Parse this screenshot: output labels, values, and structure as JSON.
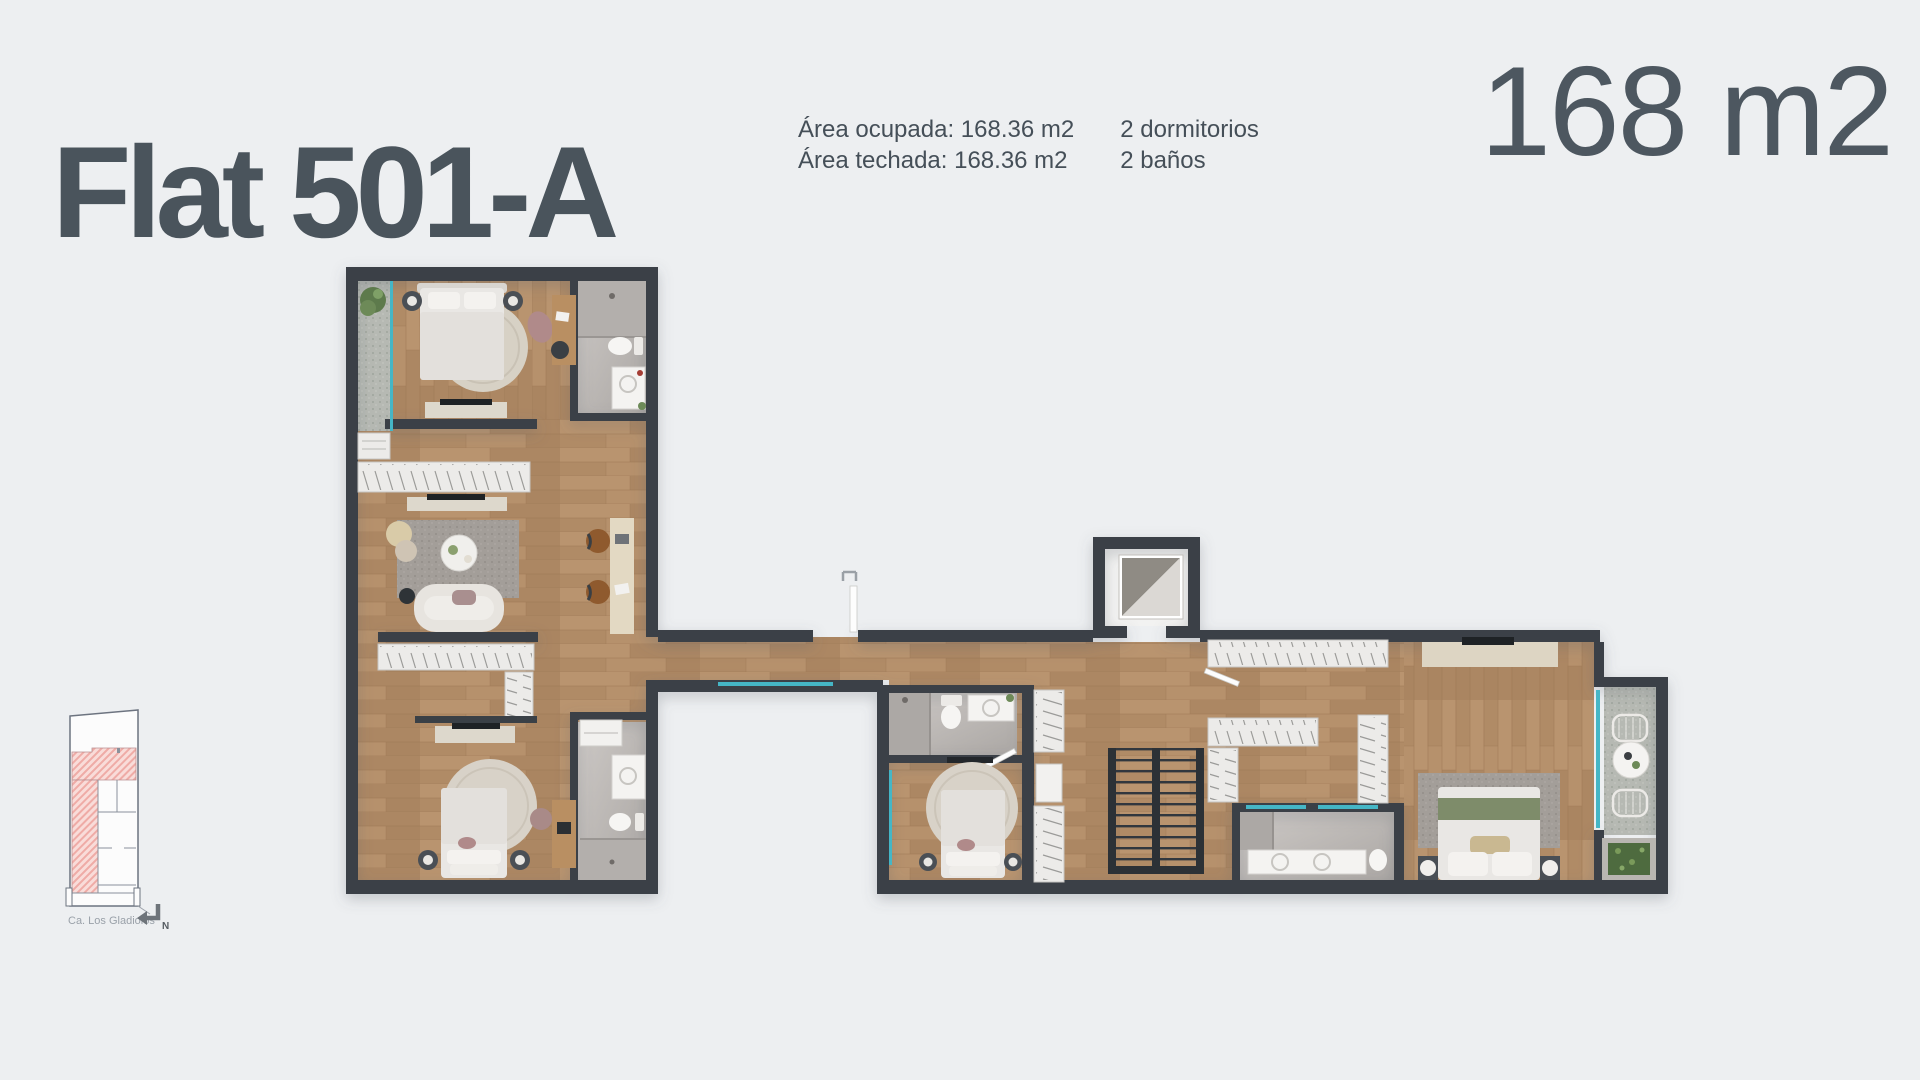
{
  "header": {
    "title": "Flat 501-A",
    "area_occupied": "Área ocupada: 168.36 m2",
    "area_roofed": "Área techada: 168.36 m2",
    "bedrooms": "2 dormitorios",
    "bathrooms": "2 baños",
    "total_area": "168 m2"
  },
  "minimap": {
    "street_label": "Ca. Los Gladiolos",
    "north_label": "N",
    "highlight_color": "#f3b6b2"
  },
  "floorplan": {
    "colors": {
      "background": "#edeff1",
      "wall": "#3a4046",
      "wood_floor": "#b28e6a",
      "bathroom_floor": "#c0bcb9",
      "glass_accent": "#45b6c6",
      "furniture_white": "#ecebe9",
      "bed_blanket_green": "#7e8c6a"
    }
  }
}
